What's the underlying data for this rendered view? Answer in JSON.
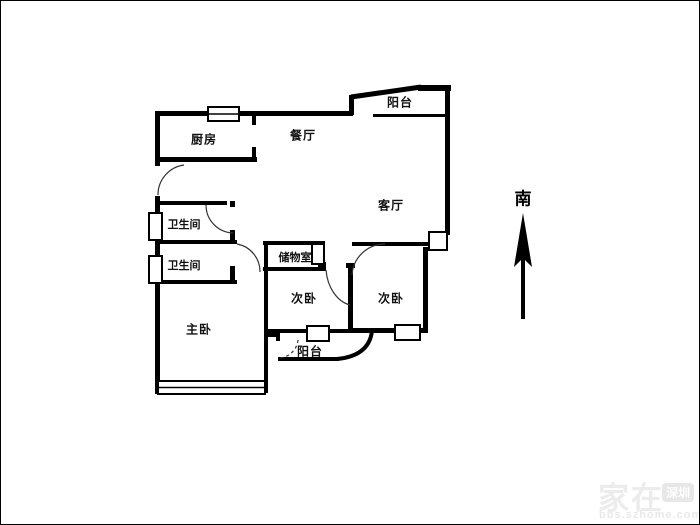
{
  "floorplan": {
    "rooms": [
      {
        "id": "kitchen",
        "label": "厨房",
        "x": 203,
        "y": 138,
        "small": false
      },
      {
        "id": "dining",
        "label": "餐厅",
        "x": 302,
        "y": 134,
        "small": false
      },
      {
        "id": "balcony-top",
        "label": "阳台",
        "x": 399,
        "y": 101,
        "small": false
      },
      {
        "id": "living",
        "label": "客厅",
        "x": 390,
        "y": 204,
        "small": false
      },
      {
        "id": "bathroom-1",
        "label": "卫生间",
        "x": 183,
        "y": 223,
        "small": true
      },
      {
        "id": "bathroom-2",
        "label": "卫生间",
        "x": 183,
        "y": 264,
        "small": true
      },
      {
        "id": "storage",
        "label": "储物室",
        "x": 294,
        "y": 256,
        "small": true
      },
      {
        "id": "bedroom-left",
        "label": "次卧",
        "x": 303,
        "y": 297,
        "small": false
      },
      {
        "id": "bedroom-right",
        "label": "次卧",
        "x": 390,
        "y": 297,
        "small": false
      },
      {
        "id": "master-bedroom",
        "label": "主卧",
        "x": 198,
        "y": 328,
        "small": false
      },
      {
        "id": "balcony-bottom",
        "label": "阳台",
        "x": 309,
        "y": 350,
        "small": false
      }
    ],
    "compass": {
      "label": "南",
      "direction": "south"
    },
    "colors": {
      "wall": "#000000",
      "label": "#111111",
      "watermark": "#ebebeb"
    }
  },
  "watermark": {
    "brand": "家在",
    "badge": "深圳",
    "site": "bbs.szhome.com"
  }
}
